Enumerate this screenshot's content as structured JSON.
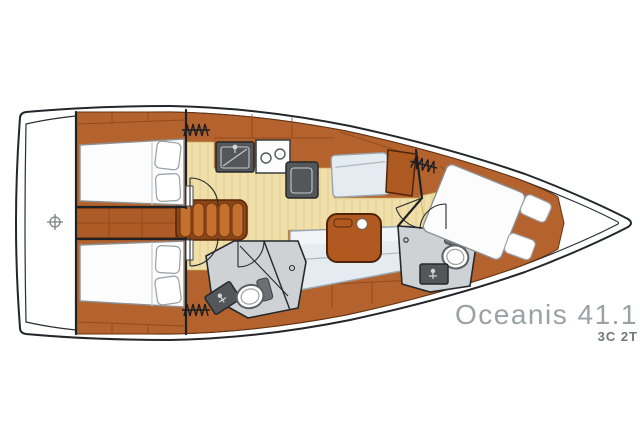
{
  "title": {
    "model": "Oceanis 41.1",
    "variant": "3C 2T"
  },
  "diagram": {
    "type": "yacht-interior-floor-plan",
    "orientation": "bow-right-stern-left",
    "features": [
      "hull-outline",
      "deck-line",
      "stern-platform",
      "centerline-marker",
      "aft-cabin-upper-double-bed",
      "aft-cabin-lower-double-bed",
      "engine-box",
      "companionway-steps",
      "galley-sink",
      "galley-stove-two-burners",
      "galley-fridge",
      "nav-station-seat",
      "chart-table",
      "saloon-settee",
      "saloon-table",
      "mid-head-toilet",
      "mid-head-sink",
      "mid-head-shower",
      "forward-head-toilet",
      "forward-head-sink",
      "forward-cabin-island-bed",
      "hanging-locker-symbols",
      "door-swing-arcs"
    ]
  },
  "colors": {
    "wood": "#b4632e",
    "wood_dark": "#7a3a12",
    "wood_deep": "#8a4517",
    "floor": "#f0dfa9",
    "floor_seam": "#e0cc92",
    "hull_line": "#23262a",
    "appliance": "#53575a",
    "head_floor": "#ced2d5",
    "upholstery": "#e4ebf1",
    "bed": "#fcfcfc",
    "steps": "#c4702f",
    "table": "#b05a21",
    "title_text": "#9aa2a6",
    "subtitle_text": "#6e787d"
  }
}
